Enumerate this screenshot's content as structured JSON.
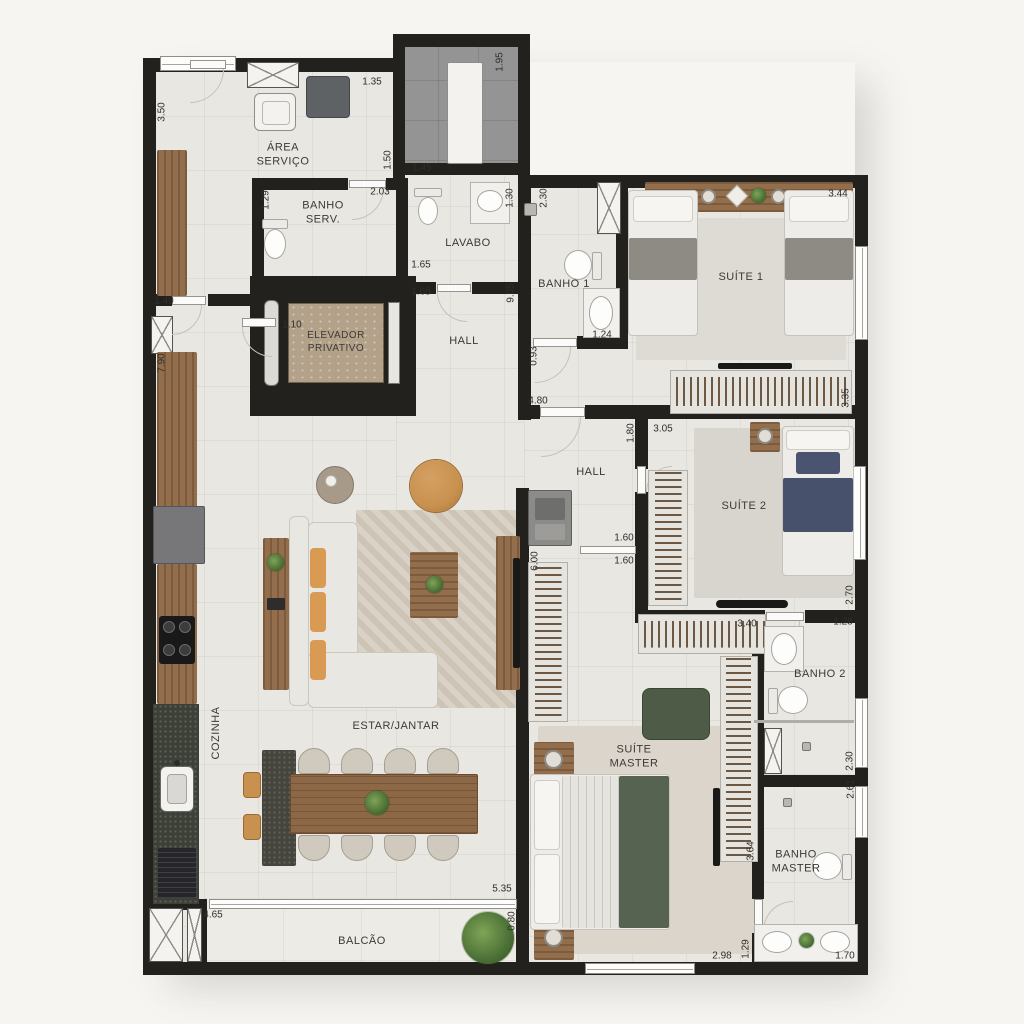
{
  "plan": {
    "type": "apartment-floor-plan",
    "units": "meters",
    "colors": {
      "wall": "#22211e",
      "floor": "#e9e7e2",
      "technical_floor": "#949494",
      "wood": "#926e4d",
      "stone": "#45443d",
      "marble": "#b3a189",
      "green_bed": "#566351",
      "navy_bed": "#47516c",
      "caramel": "#c8914f",
      "label_text": "#3b3a36"
    },
    "rooms": [
      {
        "id": "area-servico",
        "name": "ÁREA\nSERVIÇO"
      },
      {
        "id": "banho-serv",
        "name": "BANHO\nSERV."
      },
      {
        "id": "lavabo",
        "name": "LAVABO"
      },
      {
        "id": "elevador",
        "name": "ELEVADOR\nPRIVATIVO"
      },
      {
        "id": "hall-1",
        "name": "HALL"
      },
      {
        "id": "banho-1",
        "name": "BANHO 1"
      },
      {
        "id": "suite-1",
        "name": "SUÍTE 1"
      },
      {
        "id": "hall-2",
        "name": "HALL"
      },
      {
        "id": "suite-2",
        "name": "SUÍTE 2"
      },
      {
        "id": "banho-2",
        "name": "BANHO 2"
      },
      {
        "id": "estar-jantar",
        "name": "ESTAR/JANTAR"
      },
      {
        "id": "cozinha",
        "name": "COZINHA"
      },
      {
        "id": "suite-master",
        "name": "SUÍTE\nMASTER"
      },
      {
        "id": "banho-master",
        "name": "BANHO\nMASTER"
      },
      {
        "id": "balcao",
        "name": "BALCÃO"
      }
    ],
    "dimensions": [
      {
        "v": "3.50",
        "x": 162,
        "y": 112,
        "o": "v"
      },
      {
        "v": "1.35",
        "x": 372,
        "y": 82,
        "o": "h"
      },
      {
        "v": "1.95",
        "x": 500,
        "y": 62,
        "o": "v"
      },
      {
        "v": "1.50",
        "x": 388,
        "y": 160,
        "o": "v"
      },
      {
        "v": "1.45",
        "x": 422,
        "y": 168,
        "o": "h"
      },
      {
        "v": "1.29",
        "x": 266,
        "y": 200,
        "o": "v"
      },
      {
        "v": "2.03",
        "x": 380,
        "y": 192,
        "o": "h"
      },
      {
        "v": "1.30",
        "x": 510,
        "y": 198,
        "o": "v"
      },
      {
        "v": "2.30",
        "x": 544,
        "y": 198,
        "o": "v"
      },
      {
        "v": "3.44",
        "x": 838,
        "y": 194,
        "o": "h"
      },
      {
        "v": "1.65",
        "x": 421,
        "y": 265,
        "o": "h"
      },
      {
        "v": "1.65",
        "x": 421,
        "y": 292,
        "o": "h"
      },
      {
        "v": "1.40",
        "x": 164,
        "y": 301,
        "o": "h"
      },
      {
        "v": "1.10",
        "x": 292,
        "y": 325,
        "o": "h"
      },
      {
        "v": "7.90",
        "x": 162,
        "y": 363,
        "o": "v"
      },
      {
        "v": "9.05",
        "x": 511,
        "y": 293,
        "o": "v"
      },
      {
        "v": "1.24",
        "x": 602,
        "y": 335,
        "o": "h"
      },
      {
        "v": "0.93",
        "x": 534,
        "y": 356,
        "o": "v"
      },
      {
        "v": "3.35",
        "x": 846,
        "y": 398,
        "o": "v"
      },
      {
        "v": "4.80",
        "x": 538,
        "y": 401,
        "o": "h"
      },
      {
        "v": "1.80",
        "x": 631,
        "y": 433,
        "o": "v"
      },
      {
        "v": "3.05",
        "x": 663,
        "y": 429,
        "o": "h"
      },
      {
        "v": "1.60",
        "x": 624,
        "y": 538,
        "o": "h"
      },
      {
        "v": "1.60",
        "x": 624,
        "y": 561,
        "o": "h"
      },
      {
        "v": "6.00",
        "x": 535,
        "y": 561,
        "o": "v"
      },
      {
        "v": "2.70",
        "x": 850,
        "y": 595,
        "o": "v"
      },
      {
        "v": "1.28",
        "x": 843,
        "y": 622,
        "o": "h"
      },
      {
        "v": "3.40",
        "x": 747,
        "y": 624,
        "o": "h"
      },
      {
        "v": "2.30",
        "x": 850,
        "y": 761,
        "o": "v"
      },
      {
        "v": "2.61",
        "x": 851,
        "y": 789,
        "o": "v"
      },
      {
        "v": "3.64",
        "x": 751,
        "y": 851,
        "o": "v"
      },
      {
        "v": "5.35",
        "x": 502,
        "y": 889,
        "o": "h"
      },
      {
        "v": "0.80",
        "x": 512,
        "y": 921,
        "o": "v"
      },
      {
        "v": "4.65",
        "x": 213,
        "y": 915,
        "o": "h"
      },
      {
        "v": "2.98",
        "x": 722,
        "y": 956,
        "o": "h"
      },
      {
        "v": "1.29",
        "x": 746,
        "y": 949,
        "o": "v"
      },
      {
        "v": "1.70",
        "x": 845,
        "y": 956,
        "o": "h"
      }
    ]
  }
}
